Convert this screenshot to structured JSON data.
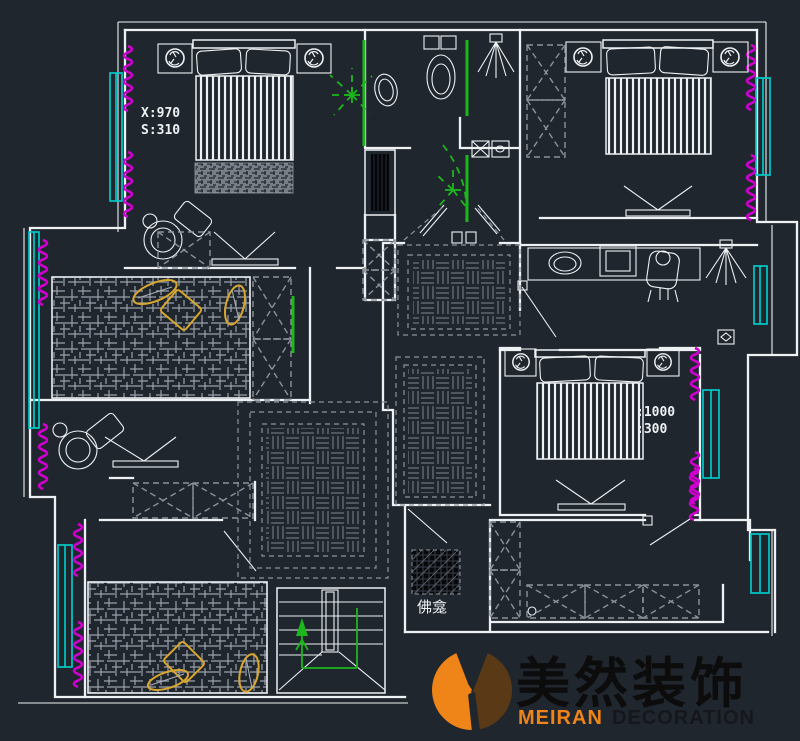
{
  "meta": {
    "title": "residential floor plan CAD drawing"
  },
  "colors": {
    "bg": "#20262e",
    "line": "#eef1f4",
    "dash": "#8b929b",
    "hatch": "#99a1ab",
    "parquet": "#7e858f",
    "window": "#00c8c8",
    "radiator": "#cf00cf",
    "light": "#1db61d",
    "gold": "#d9a62e",
    "logo_orange": "#ef8418",
    "logo_brown": "#5a3a16",
    "logo_text": "#0c0c0c"
  },
  "plan": {
    "dim_note_top_left": {
      "line1": "X:970",
      "line2": "S:310"
    },
    "dim_note_mid_right": {
      "line1": ":1000",
      "line2": ":300"
    },
    "shrine_label": "佛龛"
  },
  "logo": {
    "cn": "美然装饰",
    "en_bold": "MEIRAN",
    "en_rest": "DECORATION"
  },
  "icons": [
    "bed-icon",
    "pillow-icon",
    "nightstand-lamp-icon",
    "tv-icon",
    "armchair-icon",
    "toilet-icon",
    "shower-icon",
    "mirror-icon",
    "monitor-icon",
    "desk-chair-person-icon",
    "wall-lamp-icon",
    "ceiling-light-icon",
    "stair-icon",
    "stair-direction-arrow",
    "window-icon",
    "radiator-icon",
    "wardrobe-icon",
    "shrine-icon",
    "logo-mark"
  ]
}
